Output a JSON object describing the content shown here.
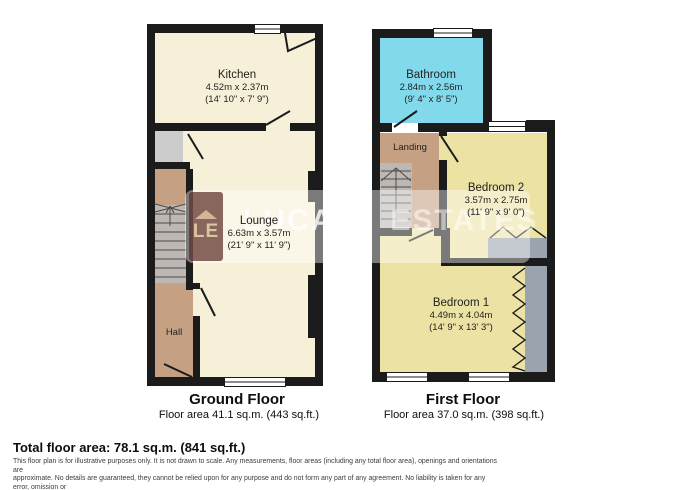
{
  "ground_floor": {
    "title": "Ground Floor",
    "area": "Floor area 41.1 sq.m. (443 sq.ft.)",
    "kitchen": {
      "name": "Kitchen",
      "metric": "4.52m x 2.37m",
      "imperial": "(14' 10\" x 7' 9\")"
    },
    "lounge": {
      "name": "Lounge",
      "metric": "6.63m x 3.57m",
      "imperial": "(21' 9\" x 11' 9\")"
    },
    "hall": {
      "name": "Hall"
    }
  },
  "first_floor": {
    "title": "First Floor",
    "area": "Floor area 37.0 sq.m. (398 sq.ft.)",
    "bathroom": {
      "name": "Bathroom",
      "metric": "2.84m x 2.56m",
      "imperial": "(9' 4\" x 8' 5\")"
    },
    "landing": {
      "name": "Landing"
    },
    "bedroom2": {
      "name": "Bedroom 2",
      "metric": "3.57m x 2.75m",
      "imperial": "(11' 9\" x 9' 0\")"
    },
    "bedroom1": {
      "name": "Bedroom 1",
      "metric": "4.49m x 4.04m",
      "imperial": "(14' 9\" x 13' 3\")"
    }
  },
  "summary": {
    "total": "Total floor area: 78.1 sq.m. (841 sq.ft.)"
  },
  "disclaimer": {
    "line1": "This floor plan is for illustrative purposes only. It is not drawn to scale. Any measurements, floor areas (including any total floor area), openings and orientations are",
    "line2": "approximate. No details are guaranteed, they cannot be relied upon for any purpose and do not form any part of any agreement. No liability is taken for any error, omission or",
    "line3": "misstatement. A party must rely upon its own inspection(s). Powered by www.Propertybox.io"
  },
  "watermark": {
    "logo": "LE",
    "brand_primary": "LUCAS",
    "brand_secondary": "ESTATES"
  },
  "colors": {
    "wall": "#1b1b1b",
    "cream": "#f7f0d8",
    "yellow": "#ece2a4",
    "cyan": "#82d9ec",
    "tan": "#c5a083",
    "stairgray": "#bdb8b4",
    "wardrobe": "#9aa4ae",
    "cupboard": "#cccccc"
  }
}
